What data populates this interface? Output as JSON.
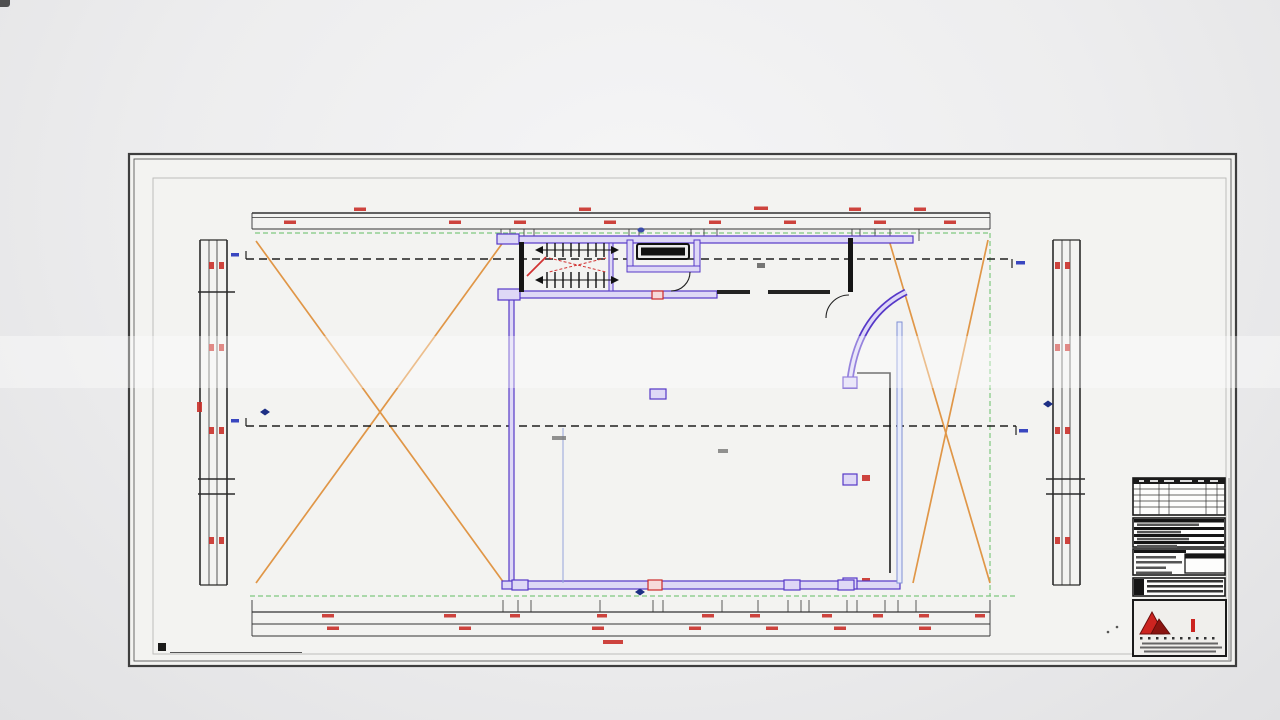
{
  "title": {
    "text": "PLANO NIVEL 4 OFICINA",
    "color": "#e64492"
  },
  "watermark": {
    "text": "VIA",
    "letters": "IA",
    "ghost_text": "VIA VIA VIA VIA VIA VIA",
    "color": "#cf8ba0",
    "positions_x": [
      22,
      152,
      282,
      412,
      542,
      672,
      802,
      932,
      1062,
      1192
    ]
  },
  "sheet": {
    "caption_prefix": "101",
    "caption": "NIVEL DE OFICINAS"
  },
  "titleblock": {
    "drawing_number": "A108",
    "logo": {
      "left": "AL",
      "right": "ED",
      "name": "ALIED"
    }
  },
  "plan": {
    "grid": {
      "columns_x": [
        253,
        394,
        527,
        662,
        724,
        796,
        846,
        989
      ],
      "rows_y": [
        239,
        292,
        382,
        479,
        494,
        581
      ],
      "col_line_top": 210,
      "col_line_bottom": 632,
      "row_line_left": 198,
      "row_line_right": 1088,
      "top_bubble_y": 202,
      "bottom_bubble_y": 640,
      "left_bubble_x": 190,
      "right_bubble_x": 1095,
      "line_color": "#b8423a",
      "bubble_color": "#8ba1dc"
    },
    "colors": {
      "wall_purple": "#5638c8",
      "wall_fill": "#ded8f6",
      "brace_orange": "#e0923e",
      "guide_green": "#7fc87f",
      "dim_red": "#c9302a",
      "ink": "#1a1a1a"
    }
  }
}
